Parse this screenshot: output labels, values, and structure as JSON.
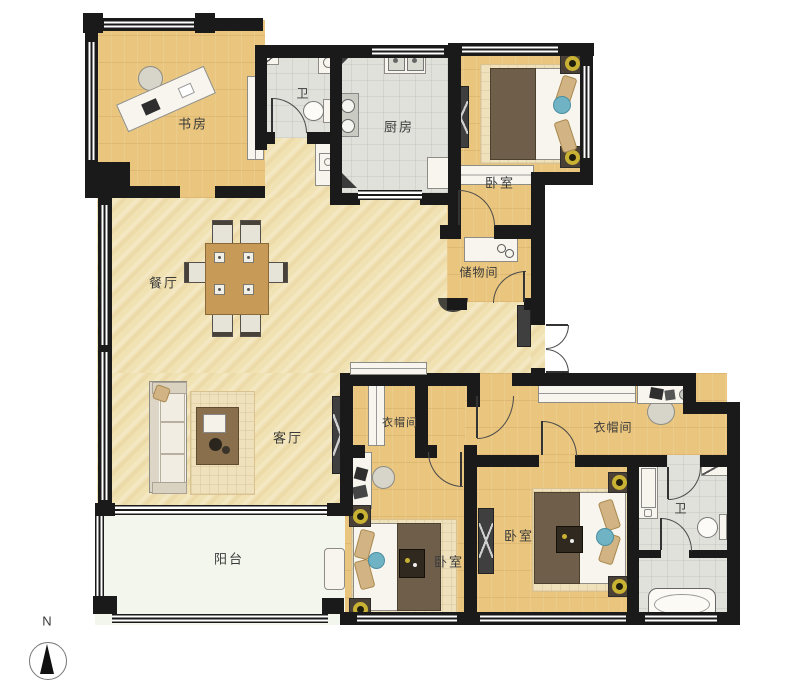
{
  "floorplan": {
    "compass_label": "N",
    "rooms": {
      "study": "书房",
      "bath_top": "卫",
      "kitchen": "厨房",
      "bedroom_top_right": "卧室",
      "storage": "储物间",
      "dining": "餐厅",
      "living": "客厅",
      "cloak_left": "衣帽间",
      "cloak_right": "衣帽间",
      "bedroom_bottom_left": "卧室",
      "bedroom_bottom_right": "卧室",
      "bath_bottom_right": "卫",
      "balcony": "阳台"
    },
    "colors": {
      "wall": "#1a1a1a",
      "wood_floor": "#e9c57d",
      "hall_floor": "#f1e2b3",
      "tile_floor": "#e0e1db",
      "balcony_floor": "#f3f6ec",
      "lamp_accent": "#c9b233",
      "blue_accent": "#6fb3c4"
    }
  }
}
